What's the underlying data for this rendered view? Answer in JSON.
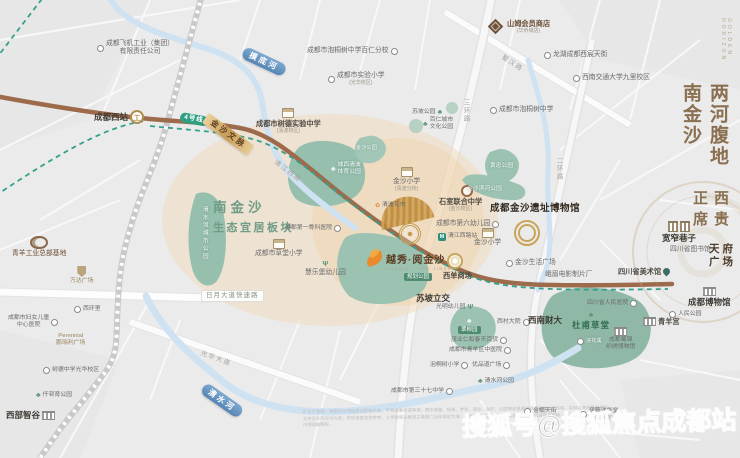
{
  "titles": {
    "main_vertical": "两河腹地南金沙",
    "sub_vertical": "西贵正席",
    "en_vertical": "GOLDEN HORIZON"
  },
  "project": {
    "name": "越秀·阅金沙",
    "en": "YUEXIU · YUE JINSHA"
  },
  "zone": {
    "line1": "南金沙",
    "line2": "生态宜居板块"
  },
  "watermark": "搜狐号@搜狐焦点成都站",
  "disclaimer": "区位示意图：本图仅为项目周边配套示意，不构成要约或承诺；图中道路、轨道、学校、商业、医疗、公园等信息源自政府相关公示内容，实际以政府最终规划文件及实际交付为准；学校信息仅供参考，入学政策以教育主管部门当年规定为准；本资料部分图片来源于网络，如有侵权请联系删除；开发商在法律允许范围内保留解释权。",
  "colors": {
    "accent_gold": "#c9a45c",
    "park_green": "#96bfae",
    "river_blue": "#6f9fc8",
    "road_brown": "#9d6b4c",
    "metro_green": "#2f9e82",
    "peach_zone": "#f2d9ba"
  },
  "labels": [
    {
      "n": "poi-chengfei",
      "t": "成都飞机工业（集团）",
      "t2": "有限责任公司",
      "x": 97,
      "y": 40,
      "c": "ctr",
      "i": "dot",
      "ip": "l"
    },
    {
      "n": "poi-paotongshu-bairen",
      "t": "成都市泡桐树中学百仁分校",
      "x": 307,
      "y": 47,
      "i": "dot",
      "ip": "r"
    },
    {
      "n": "poi-shiyan-primary",
      "t": "成都市实验小学",
      "s": "(光华校区)",
      "x": 328,
      "y": 72,
      "c": "ctr",
      "i": "dot",
      "ip": "l"
    },
    {
      "n": "poi-sams-club",
      "t": "山姆会员商店",
      "s": "(华侨城店)",
      "x": 486,
      "y": 19,
      "c": "brown b ctr",
      "i": "diamond",
      "ip": "l"
    },
    {
      "n": "poi-longhu-tianjie",
      "t": "龙湖成都西宸天街",
      "x": 544,
      "y": 51,
      "i": "dot",
      "ip": "l"
    },
    {
      "n": "poi-jiaotong-univ",
      "t": "西南交通大学九里校区",
      "x": 573,
      "y": 74,
      "i": "dot",
      "ip": "l"
    },
    {
      "n": "poi-paotongshu-middle",
      "t": "成都市泡桐树中学",
      "x": 490,
      "y": 106,
      "i": "dot",
      "ip": "l"
    },
    {
      "n": "poi-shude-exp-middle",
      "t": "成都市树德实验中学",
      "s": "(清波校区)",
      "x": 256,
      "y": 108,
      "c": "b ctr",
      "i": "school",
      "ip": "t"
    },
    {
      "n": "park-supo",
      "t": "苏坡公园",
      "x": 412,
      "y": 109,
      "c": "tiny",
      "i": "tree",
      "ip": "r"
    },
    {
      "n": "park-bairen-culture",
      "t": "百仁城市",
      "t2": "文化公园",
      "x": 423,
      "y": 117,
      "c": "tiny ctr",
      "i": "tree",
      "ip": "l"
    },
    {
      "n": "poi-jinsha-primary-qingbo",
      "t": "金沙小学",
      "s": "(清波分校)",
      "x": 393,
      "y": 167,
      "c": "ctr",
      "i": "school",
      "ip": "t"
    },
    {
      "n": "poi-qingbo-flower-market",
      "t": "清波花市",
      "x": 375,
      "y": 202,
      "c": "tiny",
      "i": "flower",
      "ip": "l"
    },
    {
      "n": "poi-shishi-united",
      "t": "石室联合中学",
      "s": "(金沙校区)",
      "x": 439,
      "y": 197,
      "c": "b ctr"
    },
    {
      "n": "poi-no6-kindergarten",
      "t": "成都市第六幼儿园",
      "x": 436,
      "y": 220,
      "i": "dot",
      "ip": "r"
    },
    {
      "n": "station-qingjiangxilu",
      "t": "清江西路站",
      "x": 438,
      "y": 233,
      "c": "tiny",
      "i": "metro",
      "ip": "l"
    },
    {
      "n": "poi-jinsha-primary",
      "t": "金沙小学",
      "x": 474,
      "y": 228,
      "c": "ctr",
      "i": "school",
      "ip": "t"
    },
    {
      "n": "poi-orthopedic-hospital",
      "t": "成都第一骨科医院",
      "x": 285,
      "y": 225,
      "c": "tiny",
      "i": "dot",
      "ip": "r"
    },
    {
      "n": "poi-caotang-primary",
      "t": "成都市草堂小学",
      "x": 255,
      "y": 239,
      "c": "ctr",
      "i": "school",
      "ip": "t"
    },
    {
      "n": "poi-huilebao-kindergarten",
      "t": "慧乐堡幼儿园",
      "x": 305,
      "y": 261,
      "c": "ctr",
      "i": "treeY",
      "ip": "t"
    },
    {
      "n": "poi-xidan-mall",
      "t": "西单商场",
      "x": 443,
      "y": 271,
      "c": "b"
    },
    {
      "n": "poi-jinsha-life-plaza",
      "t": "金沙生活广场",
      "x": 506,
      "y": 259,
      "i": "dot",
      "ip": "l"
    },
    {
      "n": "poi-emei-film-studio",
      "t": "峨眉电影制片厂",
      "x": 545,
      "y": 271
    },
    {
      "n": "poi-jinsha-site-museum",
      "t": "成都金沙遗址博物馆",
      "x": 490,
      "y": 203,
      "c": "big"
    },
    {
      "n": "park-huangzhong",
      "t": "黄忠公园",
      "x": 490,
      "y": 163,
      "c": "pk"
    },
    {
      "n": "park-jinsha-binhe",
      "t": "金沙滨河公园",
      "x": 467,
      "y": 186,
      "c": "pk"
    },
    {
      "n": "park-chengxi-sports",
      "t": "城西清波",
      "t2": "体育公园",
      "x": 331,
      "y": 162,
      "c": "pk ctr",
      "i": "tree",
      "ip": "l"
    },
    {
      "n": "park-jinsha",
      "t": "金沙公园",
      "x": 356,
      "y": 145,
      "c": "pk tiny"
    },
    {
      "n": "park-qingshuihe-city",
      "t": "清水河城市公园",
      "x": 200,
      "y": 206,
      "c": "pk vert"
    },
    {
      "n": "poi-qingyang-industrial-hq",
      "t": "青羊工业总部基地",
      "x": 12,
      "y": 236,
      "c": "brown ctr",
      "i": "swirl",
      "ip": "t"
    },
    {
      "n": "poi-wanda-plaza",
      "t": "万达广场",
      "x": 70,
      "y": 266,
      "c": "tiny gold ctr",
      "i": "crest",
      "ip": "t"
    },
    {
      "n": "road-riyue-expressway",
      "t": "日月大道快速路",
      "x": 201,
      "y": 290,
      "c": "pillrd"
    },
    {
      "n": "poi-xihuanli",
      "t": "西环里",
      "x": 74,
      "y": 306,
      "c": "tiny",
      "i": "dot",
      "ip": "l"
    },
    {
      "n": "poi-women-children-hospital",
      "t": "成都市妇女儿童",
      "t2": "中心医院",
      "x": 8,
      "y": 315,
      "c": "tiny ctr",
      "i": "dot",
      "ip": "r"
    },
    {
      "n": "poi-perennial-plaza",
      "t": "Perennial",
      "t2": "鹏瑞利广场",
      "x": 56,
      "y": 333,
      "c": "tiny gold ctr"
    },
    {
      "n": "poi-shude-guanghua",
      "t": "树德中学光华校区",
      "x": 43,
      "y": 367,
      "c": "tiny",
      "i": "dot",
      "ip": "l"
    },
    {
      "n": "park-qiancun",
      "t": "仟邨育公园",
      "x": 36,
      "y": 392,
      "c": "tiny",
      "i": "tree",
      "ip": "l"
    },
    {
      "n": "poi-xibu-zhigu",
      "t": "西部智谷",
      "x": 6,
      "y": 410,
      "c": "bb",
      "i": "bldg",
      "ip": "r"
    },
    {
      "n": "poi-supo-interchange",
      "t": "苏坡立交",
      "x": 416,
      "y": 293,
      "c": "bb"
    },
    {
      "n": "poi-guangming-kindergarten",
      "t": "光明幼儿园",
      "x": 436,
      "y": 304,
      "c": "tiny",
      "i": "treeY",
      "ip": "r"
    },
    {
      "n": "park-cuiliu",
      "t": "翠柳园",
      "x": 458,
      "y": 318,
      "c": "pkbadge ctr",
      "i": "tree",
      "ip": "t"
    },
    {
      "n": "poi-xicun-dayuan",
      "t": "西村大院",
      "x": 497,
      "y": 319,
      "c": "tiny",
      "i": "dot",
      "ip": "r"
    },
    {
      "n": "poi-swufe",
      "t": "西南财大",
      "x": 528,
      "y": 315,
      "c": "bb"
    },
    {
      "n": "poi-maoye-department",
      "t": "茂业仁和春天百货",
      "x": 451,
      "y": 337,
      "c": "tiny",
      "i": "dot",
      "ip": "r"
    },
    {
      "n": "poi-qingyang-tcm-hospital",
      "t": "成都市青羊区中医院",
      "x": 449,
      "y": 347,
      "c": "tiny",
      "i": "dot",
      "ip": "r"
    },
    {
      "n": "poi-sichuan-peoples-hospital",
      "t": "四川省人民医院",
      "x": 587,
      "y": 300,
      "c": "tiny",
      "i": "dot",
      "ip": "r"
    },
    {
      "n": "park-dufu-caotang",
      "t": "杜甫草堂",
      "x": 572,
      "y": 312,
      "c": "pkb ctr",
      "i": "tree",
      "ip": "t"
    },
    {
      "n": "poi-huanhuaxi",
      "t": "浣花溪",
      "x": 577,
      "y": 338,
      "c": "pk tiny",
      "i": "dot",
      "ip": "l"
    },
    {
      "n": "poi-qingyang-palace",
      "t": "青羊宫",
      "x": 643,
      "y": 317,
      "c": "b",
      "i": "bldg",
      "ip": "l"
    },
    {
      "n": "poi-chengdu-museum",
      "t": "成都博物馆",
      "x": 688,
      "y": 287,
      "c": "bb ctr",
      "i": "bldg",
      "ip": "t"
    },
    {
      "n": "park-renmin",
      "t": "人民公园",
      "x": 669,
      "y": 311,
      "c": "tiny",
      "i": "dot",
      "ip": "l"
    },
    {
      "n": "poi-kuanzhai-alley",
      "t": "宽窄巷子",
      "x": 662,
      "y": 221,
      "c": "bb ctr",
      "i": "bldg2",
      "ip": "t"
    },
    {
      "n": "poi-sichuan-library",
      "t": "四川省图书馆",
      "x": 670,
      "y": 246
    },
    {
      "n": "poi-sichuan-art-museum",
      "t": "四川省美术馆",
      "x": 618,
      "y": 267,
      "c": "b",
      "i": "pin",
      "ip": "r"
    },
    {
      "n": "poi-tianfu-square",
      "t": "天府",
      "t2": "广场",
      "x": 709,
      "y": 243,
      "c": "tfsq ctr"
    },
    {
      "n": "poi-shujin-museum",
      "t": "成都蜀锦",
      "t2": "织绣博物馆",
      "x": 606,
      "y": 327,
      "c": "tiny ctr",
      "i": "bldg",
      "ip": "t"
    },
    {
      "n": "poi-paotongshu-primary",
      "t": "泡桐树小学",
      "x": 430,
      "y": 362,
      "c": "tiny",
      "i": "dot",
      "ip": "r"
    },
    {
      "n": "poi-youpindao-plaza",
      "t": "优品道广场",
      "x": 472,
      "y": 362,
      "c": "tiny",
      "i": "dot",
      "ip": "r"
    },
    {
      "n": "park-qingshuihe",
      "t": "清水河公园",
      "x": 478,
      "y": 378,
      "c": "tiny",
      "i": "tree",
      "ip": "l"
    },
    {
      "n": "poi-no37-middle",
      "t": "成都市第三十七中学",
      "x": 391,
      "y": 388,
      "c": "tiny",
      "i": "dot",
      "ip": "r"
    },
    {
      "n": "poi-jinnan-tianjie",
      "t": "金楠天街",
      "x": 524,
      "y": 408,
      "c": "tiny",
      "i": "dot",
      "ip": "l"
    },
    {
      "n": "poi-ito-yokado",
      "t": "伊藤洋华堂",
      "s": "(双楠店)",
      "x": 580,
      "y": 408,
      "c": "tiny ctr",
      "i": "dot",
      "ip": "l"
    },
    {
      "n": "station-chengdu-west",
      "t": "成都西站",
      "x": 94,
      "y": 110,
      "c": "bb",
      "i": "train",
      "ip": "r"
    },
    {
      "n": "badge-metro-line4",
      "t": "4号线",
      "x": 181,
      "y": 112,
      "c": "line4",
      "r": 10
    },
    {
      "n": "road-shuhan",
      "t": "蜀汉路",
      "x": 504,
      "y": 54,
      "c": "rd",
      "r": 33
    },
    {
      "n": "road-qingjiang-west",
      "t": "清江西路",
      "x": 277,
      "y": 159,
      "c": "rd",
      "r": 37
    },
    {
      "n": "road-sanhuan",
      "t": "三环路",
      "x": 461,
      "y": 99,
      "c": "rd vertrd"
    },
    {
      "n": "road-erhuan",
      "t": "二环路",
      "x": 554,
      "y": 157,
      "c": "rd vertrd"
    },
    {
      "n": "road-guanghua-avenue",
      "t": "光华大道",
      "x": 202,
      "y": 350,
      "c": "rd",
      "r": 20
    },
    {
      "n": "river-modi",
      "t": "摸底河",
      "x": 246,
      "y": 46,
      "c": "rp",
      "r": 25
    },
    {
      "n": "river-qingshui",
      "t": "清水河",
      "x": 207,
      "y": 382,
      "c": "rp",
      "r": 35
    },
    {
      "n": "ribbon-jinsha-wenmai",
      "t": "金沙文脉",
      "x": 209,
      "y": 113,
      "c": "gr",
      "r": 36
    },
    {
      "n": "park-planned",
      "t": "规划公园",
      "x": 404,
      "y": 273,
      "c": "pkbadge"
    }
  ]
}
